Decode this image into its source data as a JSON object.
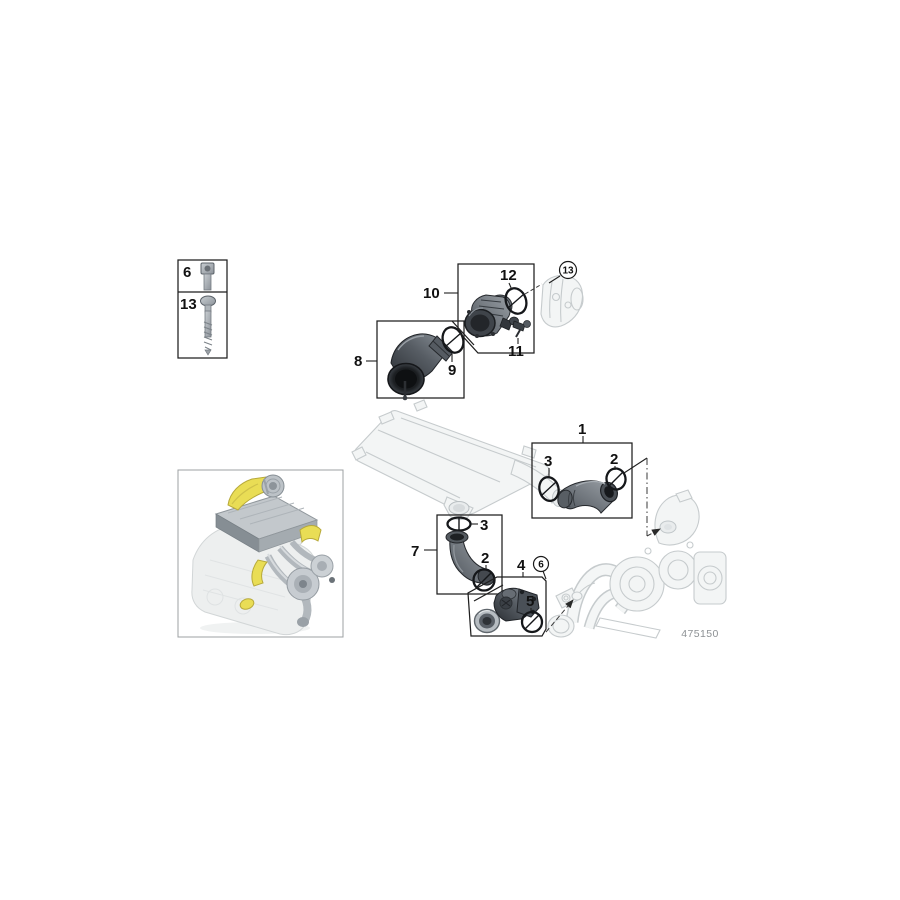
{
  "document": {
    "type": "parts-exploded-diagram",
    "subject": "charge air duct / intake air system",
    "background_color": "#ffffff"
  },
  "legend": {
    "rows": [
      {
        "label": "6",
        "part": "socket-head-screw"
      },
      {
        "label": "13",
        "part": "long-flange-screw"
      }
    ]
  },
  "callouts": {
    "n1": "1",
    "n2": "2",
    "n3": "3",
    "n4": "4",
    "n5": "5",
    "n6": "6",
    "n7": "7",
    "n8": "8",
    "n9": "9",
    "n10": "10",
    "n11": "11",
    "n12": "12",
    "n13": "13"
  },
  "footer": {
    "diagram_code": "475150"
  },
  "colors": {
    "outline": "#1f1f1f",
    "ghost_part": "#c6cbcd",
    "dark_part": "#3c4147",
    "highlight_yellow": "#e9dd55",
    "code_text": "#8d9194"
  }
}
